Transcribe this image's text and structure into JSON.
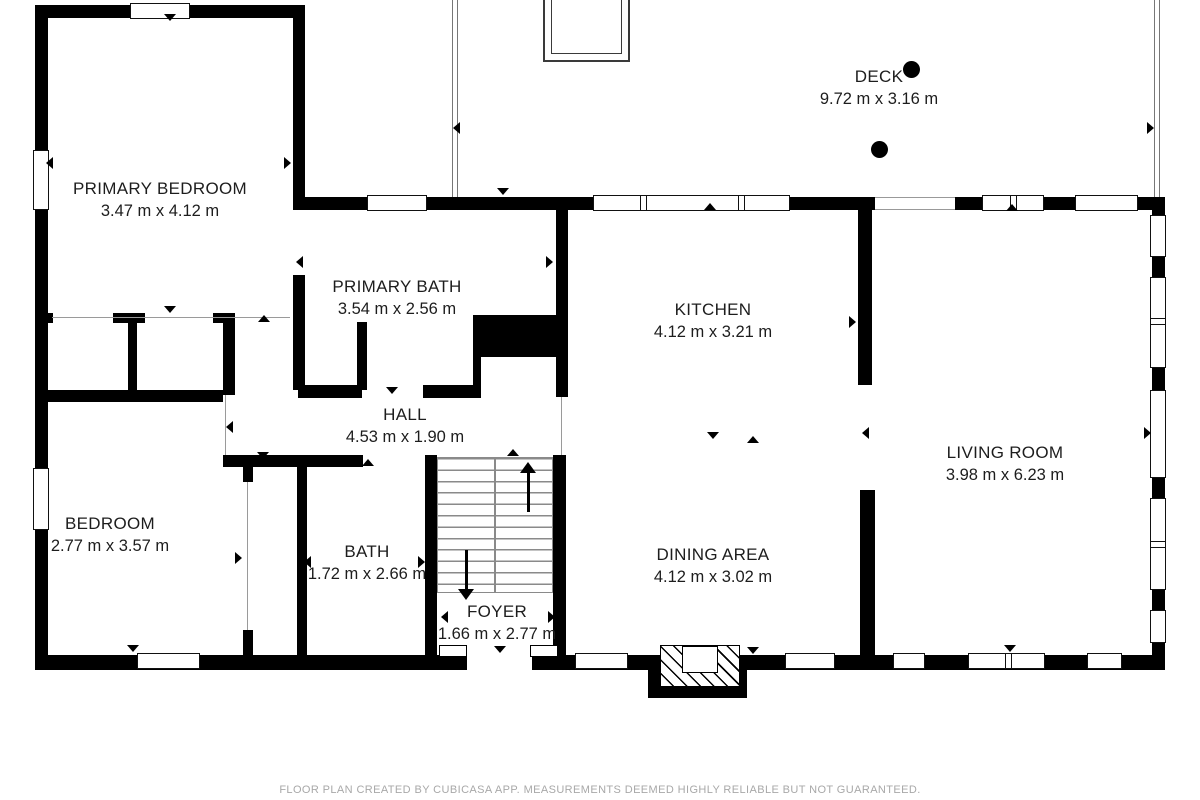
{
  "title": "Floor plan",
  "rooms": {
    "primary_bedroom": {
      "name": "PRIMARY BEDROOM",
      "dimensions": "3.47 m x 4.12 m"
    },
    "primary_bath": {
      "name": "PRIMARY BATH",
      "dimensions": "3.54 m x 2.56 m"
    },
    "deck": {
      "name": "DECK",
      "dimensions": "9.72 m x 3.16 m"
    },
    "kitchen": {
      "name": "KITCHEN",
      "dimensions": "4.12 m x 3.21 m"
    },
    "hall": {
      "name": "HALL",
      "dimensions": "4.53 m x 1.90 m"
    },
    "living_room": {
      "name": "LIVING ROOM",
      "dimensions": "3.98 m x 6.23 m"
    },
    "bedroom": {
      "name": "BEDROOM",
      "dimensions": "2.77 m x 3.57 m"
    },
    "bath": {
      "name": "BATH",
      "dimensions": "1.72 m x 2.66 m"
    },
    "foyer": {
      "name": "FOYER",
      "dimensions": "1.66 m x 2.77 m"
    },
    "dining_area": {
      "name": "DINING AREA",
      "dimensions": "4.12 m x 3.02 m"
    }
  },
  "footer": {
    "disclaimer": "FLOOR PLAN CREATED BY CUBICASA APP. MEASUREMENTS DEEMED HIGHLY RELIABLE BUT NOT GUARANTEED."
  },
  "colors": {
    "wall": "#000000",
    "background": "#ffffff",
    "label_text": "#1d1d1d",
    "footer_text": "#a8a8a8",
    "thin_line": "#9a9a9a"
  }
}
